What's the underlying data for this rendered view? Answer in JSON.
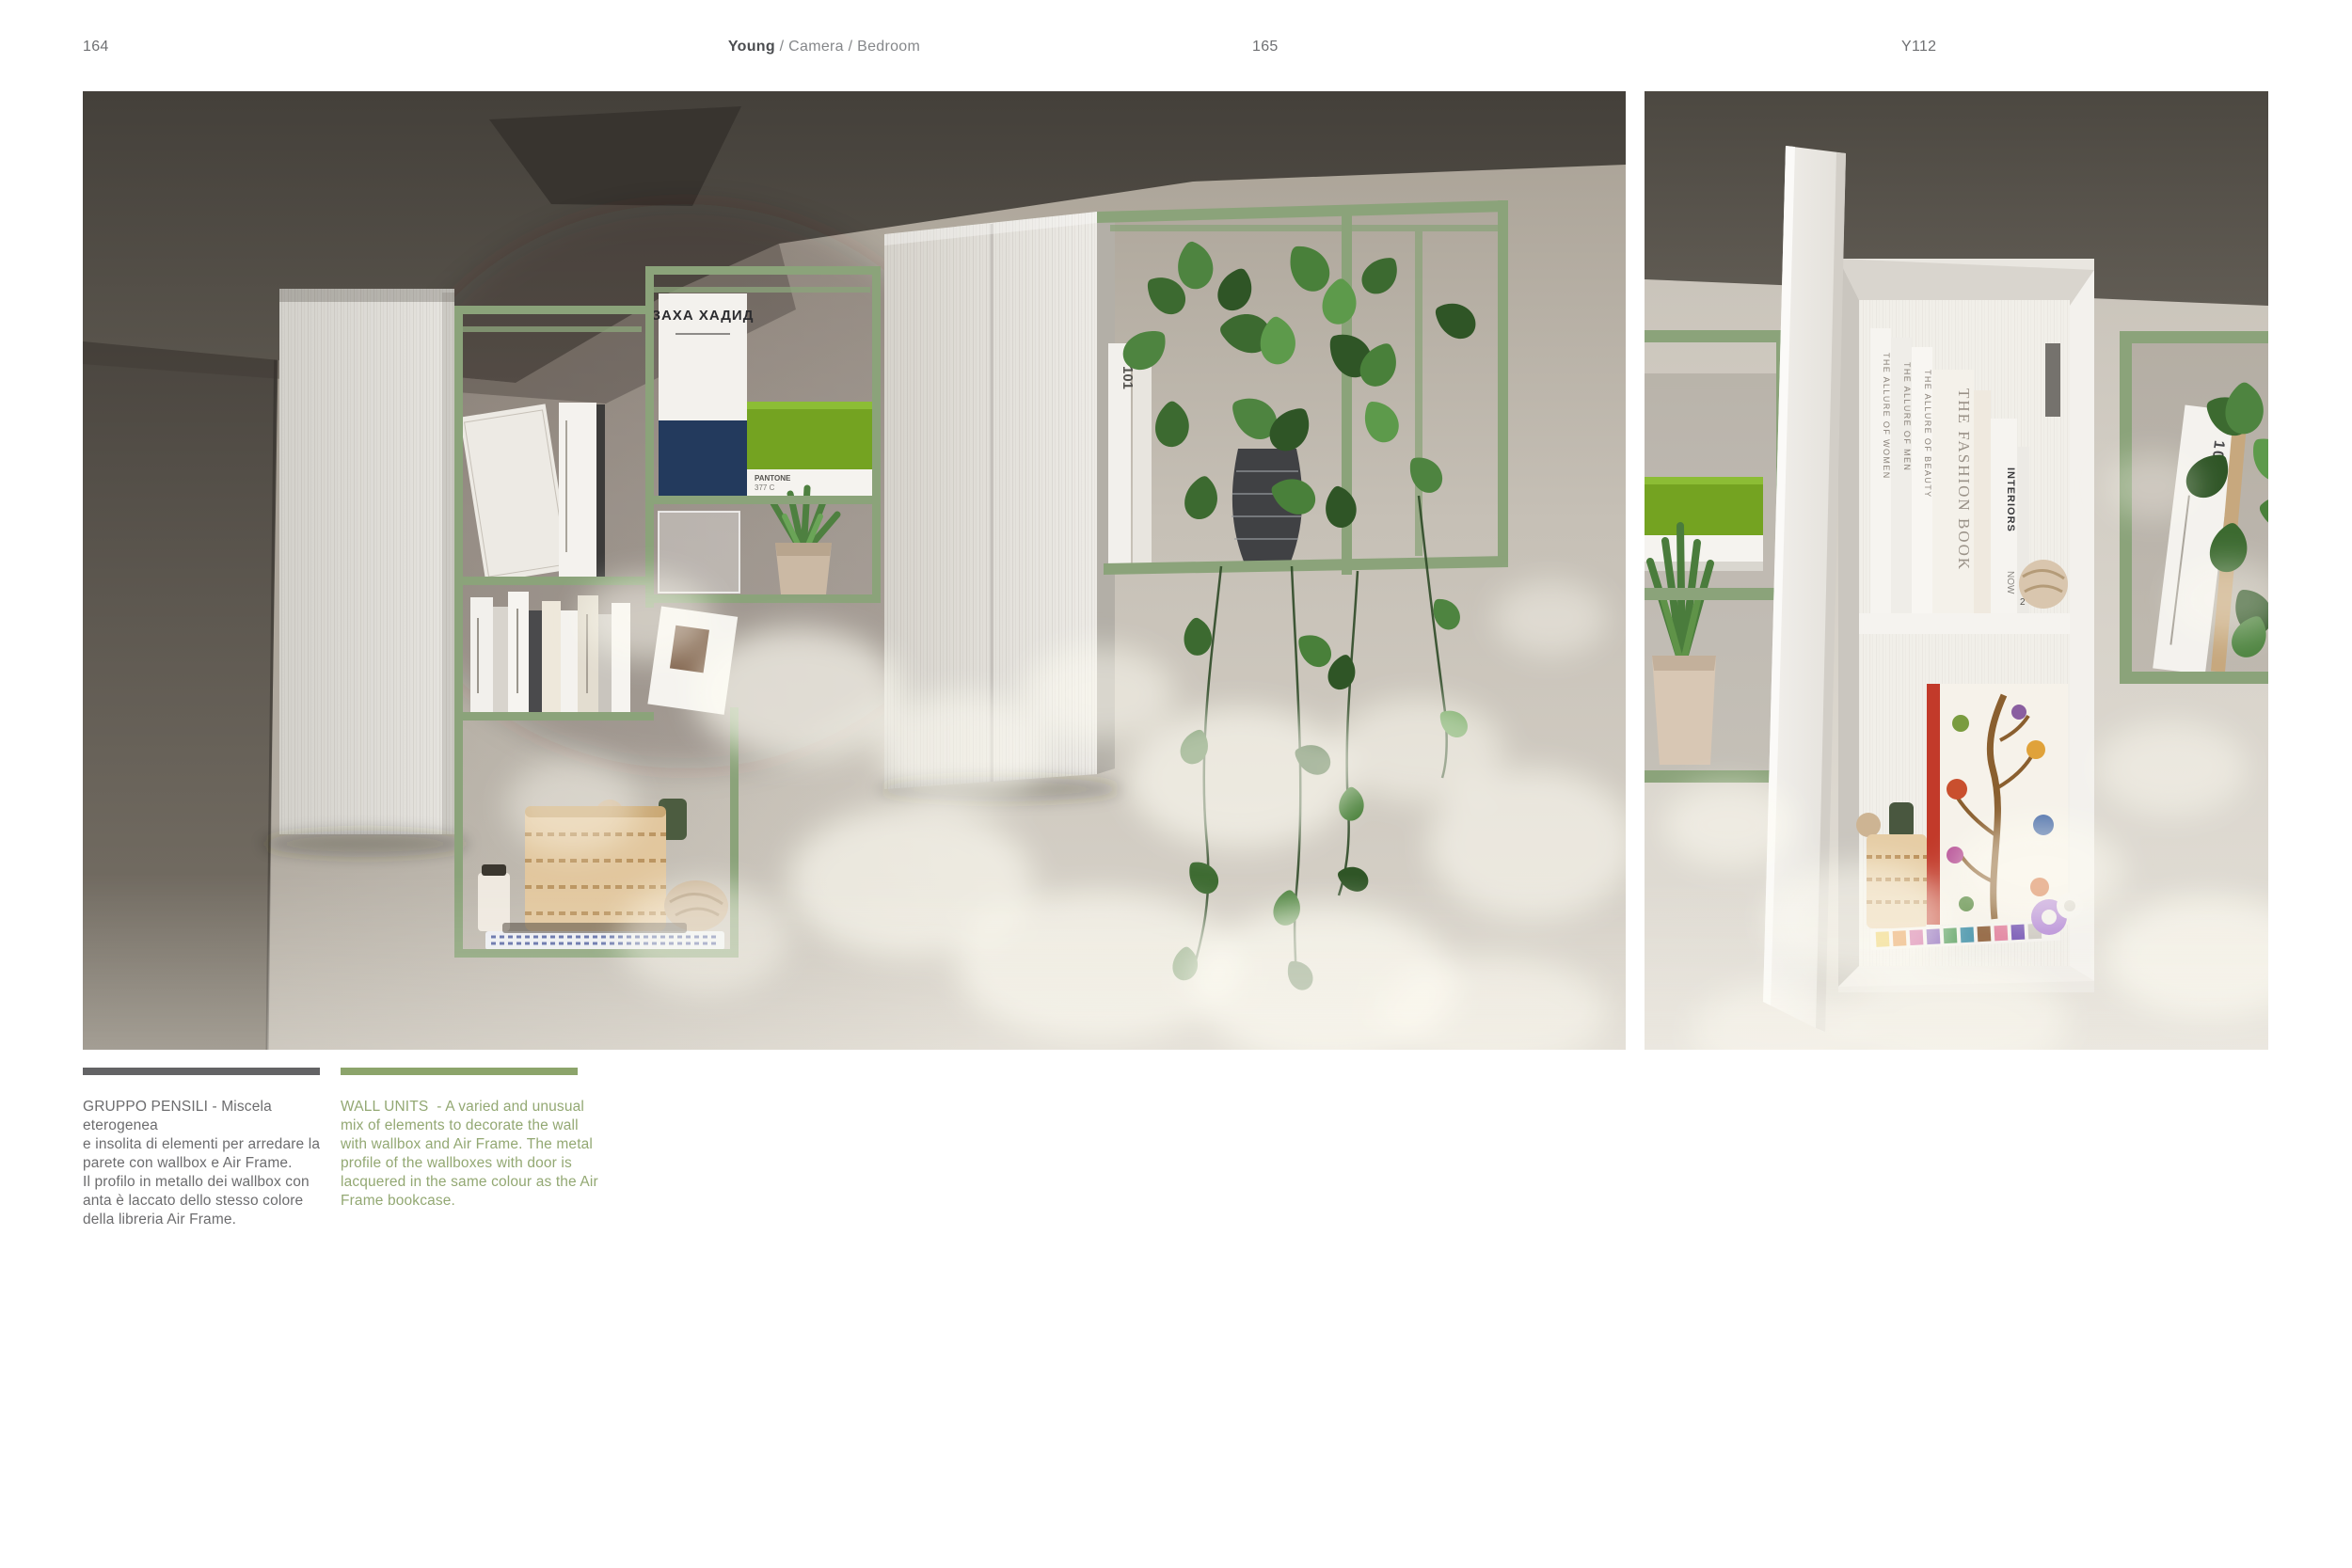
{
  "header": {
    "page_number_left": "164",
    "title_brand": "Young",
    "title_path": " / Camera / Bedroom",
    "page_number_right": "165",
    "model_code": "Y112"
  },
  "captions": {
    "italian": {
      "lines": "GRUPPO PENSILI - Miscela eterogenea\ne insolita di elementi per arredare la\nparete con wallbox e Air Frame.\nIl profilo in metallo dei wallbox con\nanta è laccato dello stesso colore\ndella libreria Air Frame."
    },
    "english": {
      "lines": "WALL UNITS  - A varied and unusual\nmix of elements to decorate the wall\nwith wallbox and Air Frame. The metal\nprofile of the wallboxes with door is\nlacquered in the same colour as the Air\nFrame bookcase."
    }
  },
  "colors": {
    "accent_green_bar": "#8ca46b",
    "caption_gray": "#6c6c6e",
    "caption_green": "#93a873",
    "bar_gray": "#636365",
    "frame_green": "#8ba37a",
    "pantone_box_green": "#74a321"
  },
  "photo_labels": {
    "zaha": "ЗАХА ХАДИД",
    "pantone_line1": "PANTONE",
    "pantone_line2": "377 C",
    "fashion_book": "THE FASHION BOOK",
    "interiors": "INTERIORS",
    "interiors_now": "NOW",
    "allure_beauty": "THE ALLURE OF BEAUTY",
    "allure_men": "THE ALLURE OF MEN",
    "allure_women": "THE ALLURE OF WOMEN",
    "book_101": "101",
    "book_104": "104",
    "book_2": "2"
  }
}
